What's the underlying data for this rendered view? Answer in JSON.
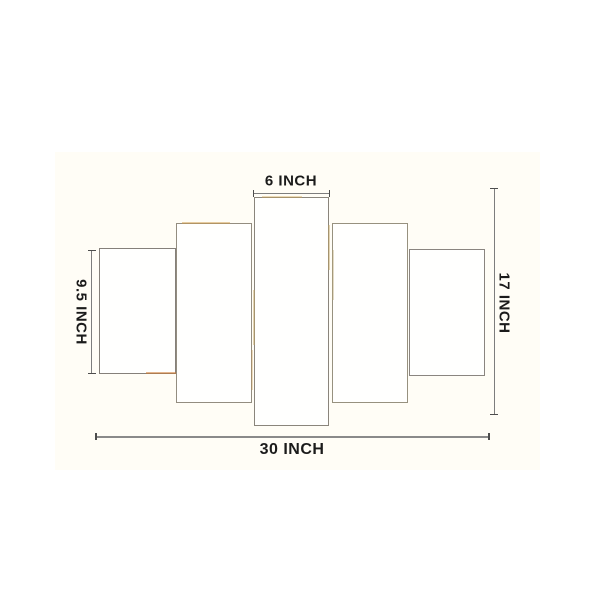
{
  "diagram": {
    "kind": "dimension-diagram",
    "panel_count": 5,
    "labels": {
      "center_panel_width": "6 INCH",
      "side_panel_height": "9.5 INCH",
      "total_height": "17 INCH",
      "total_width": "30 INCH"
    },
    "colors": {
      "background": "#ffffff",
      "photo_area": "#fffdf6",
      "panel_fill": "#fffffe",
      "panel_border": "#8d8779",
      "dimension_line": "#7d7d7d",
      "label_text": "#1b1b1b"
    }
  }
}
